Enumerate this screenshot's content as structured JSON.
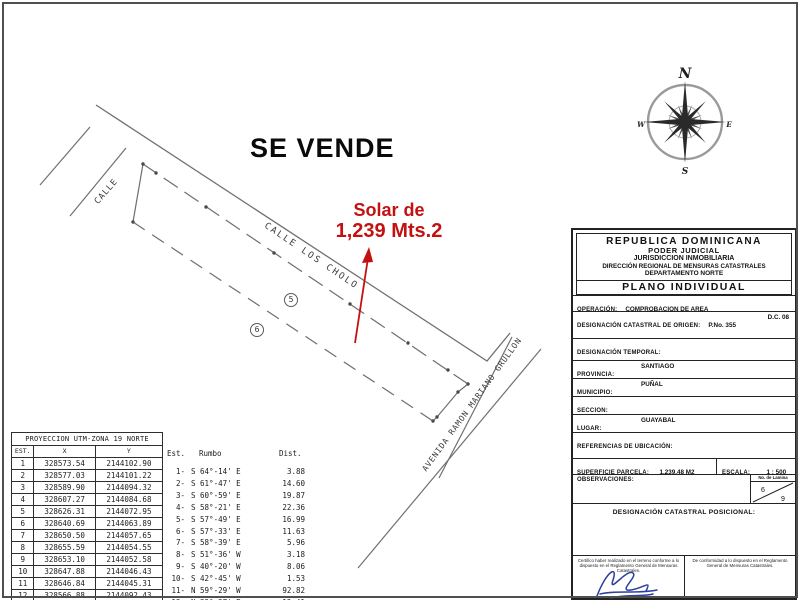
{
  "drawing": {
    "se_vende": "SE VENDE",
    "solar_line1": "Solar de",
    "solar_line2": "1,239 Mts.2",
    "street_left": "CALLE",
    "street_main": "CALLE LOS CHOLO",
    "avenue": "AVENIDA RAMON MARIANO GRULLON",
    "lot5": "5",
    "lot6": "6",
    "red_color": "#c31111",
    "line_color": "#707070"
  },
  "compass": {
    "n": "N",
    "s": "S",
    "e": "E",
    "w": "W"
  },
  "utm_table": {
    "title": "PROYECCION UTM-ZONA 19 NORTE",
    "headers": [
      "EST.",
      "X",
      "Y"
    ],
    "rows": [
      [
        "1",
        "328573.54",
        "2144102.90"
      ],
      [
        "2",
        "328577.03",
        "2144101.22"
      ],
      [
        "3",
        "328589.90",
        "2144094.32"
      ],
      [
        "4",
        "328607.27",
        "2144084.68"
      ],
      [
        "5",
        "328626.31",
        "2144072.95"
      ],
      [
        "6",
        "328640.69",
        "2144063.89"
      ],
      [
        "7",
        "328650.50",
        "2144057.65"
      ],
      [
        "8",
        "328655.59",
        "2144054.55"
      ],
      [
        "9",
        "328653.10",
        "2144052.58"
      ],
      [
        "10",
        "328647.88",
        "2144046.43"
      ],
      [
        "11",
        "328646.84",
        "2144045.31"
      ],
      [
        "12",
        "328566.88",
        "2144092.43"
      ]
    ]
  },
  "bearing_table": {
    "headers": [
      "Est.",
      "Rumbo",
      "Dist."
    ],
    "rows": [
      [
        "1-",
        "S 64°-14' E",
        "3.88"
      ],
      [
        "2-",
        "S 61°-47' E",
        "14.60"
      ],
      [
        "3-",
        "S 60°-59' E",
        "19.87"
      ],
      [
        "4-",
        "S 58°-21' E",
        "22.36"
      ],
      [
        "5-",
        "S 57°-49' E",
        "16.99"
      ],
      [
        "6-",
        "S 57°-33' E",
        "11.63"
      ],
      [
        "7-",
        "S 58°-39' E",
        "5.96"
      ],
      [
        "8-",
        "S 51°-36' W",
        "3.18"
      ],
      [
        "9-",
        "S 40°-20' W",
        "8.06"
      ],
      [
        "10-",
        "S 42°-45' W",
        "1.53"
      ],
      [
        "11-",
        "N 59°-29' W",
        "92.82"
      ],
      [
        "12-",
        "N 32°-27' E",
        "12.41"
      ]
    ]
  },
  "title_block": {
    "header_lines": [
      "REPUBLICA  DOMINICANA",
      "PODER  JUDICIAL",
      "JURISDICCION INMOBILIARIA",
      "DIRECCIÓN REGIONAL DE MENSURAS CATASTRALES",
      "DEPARTAMENTO NORTE"
    ],
    "plano": "PLANO INDIVIDUAL",
    "rows": [
      {
        "label": "OPERACIÓN:",
        "value": "COMPROBACION DE AREA",
        "extra": ""
      },
      {
        "label": "DESIGNACIÓN CATASTRAL DE ORIGEN:",
        "value": "P.No. 355",
        "extra": "D.C. 08"
      },
      {
        "label": "DESIGNACIÓN TEMPORAL:",
        "value": "",
        "extra": ""
      },
      {
        "label": "PROVINCIA:",
        "value": "SANTIAGO",
        "extra": ""
      },
      {
        "label": "MUNICIPIO:",
        "value": "PUÑAL",
        "extra": ""
      },
      {
        "label": "SECCION:",
        "value": "",
        "extra": ""
      },
      {
        "label": "LUGAR:",
        "value": "GUAYABAL",
        "extra": ""
      },
      {
        "label": "REFERENCIAS DE UBICACIÓN:",
        "value": "",
        "extra": ""
      }
    ],
    "superficie_label": "SUPERFICIE PARCELA:",
    "superficie_value": "1,239.48 M2",
    "escala_label": "ESCALA:",
    "escala_value": "1 : 500",
    "observaciones_label": "OBSERVACIONES:",
    "lamina_label": "No. de Lamina",
    "lamina_top": "6",
    "lamina_bottom": "9",
    "dcp_label": "DESIGNACIÓN CATASTRAL POSICIONAL:",
    "cert_left": "Certifico haber realizado en el terreno conforme a lo dispuesto en el Reglamento General de Mensuras Catastrales.",
    "cert_left_name": "Agrimensor JOHEL GRULLON HABANA",
    "cert_right": "De conformidad a lo dispuesto en el Reglamento General de Mensuras Catastrales.",
    "cert_right_line1": "Fecha y Firma del Director",
    "cert_right_line2": "Direccion Nacional de Mensuras Catastrales"
  }
}
